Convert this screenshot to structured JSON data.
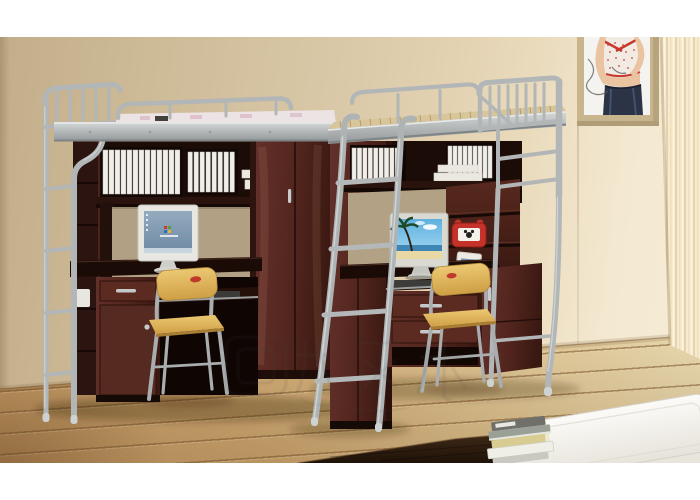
{
  "meta": {
    "domain": "natural-image",
    "description": "Product photo: two silver metal loft bunk beds with built-in dark mahogany study desks, bookshelves with white binders, computer monitors, yellow chairs, a leaning metal ladder, fashion poster, window curtain, wooden plank floor, dark rug, white ottoman bed and a stack of books",
    "canvas": {
      "width": 700,
      "height": 500
    },
    "margins": {
      "top_white_band": 37,
      "bottom_white_band": 37
    }
  },
  "photo": {
    "wall": {
      "label": "beige-wall",
      "color_left": "#c8b492",
      "color_right": "#f2e7d2"
    },
    "floor": {
      "label": "wood-plank-floor",
      "wood_color": "#d9b67e",
      "plank_line_color": "#8a5f33"
    },
    "rug": {
      "label": "dark-brown-rug",
      "color": "#2e1b0d"
    },
    "poster": {
      "label": "fashion-poster",
      "frame_color": "#c9b58d",
      "subject": "woman in red-trim polka-dot top and dark jeans",
      "legible_text": false
    },
    "curtain": {
      "label": "window-curtain",
      "color": "#f3e2c2"
    },
    "watermark": {
      "present": true,
      "legible": false,
      "position": "center-lower"
    },
    "left_unit": {
      "label": "loft-bed-desk-unit-left",
      "frame_color": "#b4b8b9",
      "wood_color": "#4f241c",
      "mattress_color": "#ece3e4",
      "shelf_contents": [
        "white-binders-row-13",
        "white-binders-row-8",
        "flat-white-boxes"
      ],
      "monitor": {
        "label": "crt-monitor",
        "screen": "windows-xp-desktop",
        "bezel_color": "#e8e7e2"
      },
      "chair": {
        "label": "study-chair",
        "seat_color": "#e0b45c",
        "frame_color": "#b4b8b9",
        "badge_color": "#c0392b"
      },
      "storage": [
        "side-cubby-shelves",
        "tall-wardrobe-two-doors",
        "under-desk-drawer-cabinet",
        "keyboard-tray"
      ]
    },
    "ladder": {
      "label": "leaning-metal-ladder",
      "rungs": 4,
      "color": "#b0b4b5"
    },
    "right_unit": {
      "label": "loft-bed-desk-unit-right",
      "frame_color": "#b4b8b9",
      "wood_color": "#4f241c",
      "deck_color": "#d8c59a",
      "shelf_contents": [
        "white-binders-row-9",
        "white-binders-row-9",
        "flat-white-boxes"
      ],
      "monitor": {
        "label": "lcd-monitor",
        "screen": "beach-wallpaper",
        "bezel_color": "#d9d9d2"
      },
      "chair": {
        "label": "study-chair",
        "seat_color": "#e0b45c",
        "frame_color": "#b4b8b9",
        "badge_color": "#c0392b"
      },
      "accessories": [
        "red-alarm-clock",
        "magazine"
      ],
      "storage": [
        "left-locker-cabinet",
        "two-drawer-pedestal",
        "side-cabinet",
        "keyboard-tray",
        "corner-shelf"
      ]
    },
    "bench": {
      "label": "white-ottoman-bed",
      "color": "#f2f0ea"
    },
    "books": {
      "label": "book-stack",
      "count": 5,
      "spine_colors": [
        "#70706a",
        "#9aa096",
        "#d9cc92",
        "#f0efe7",
        "#c9c9c1"
      ]
    }
  }
}
